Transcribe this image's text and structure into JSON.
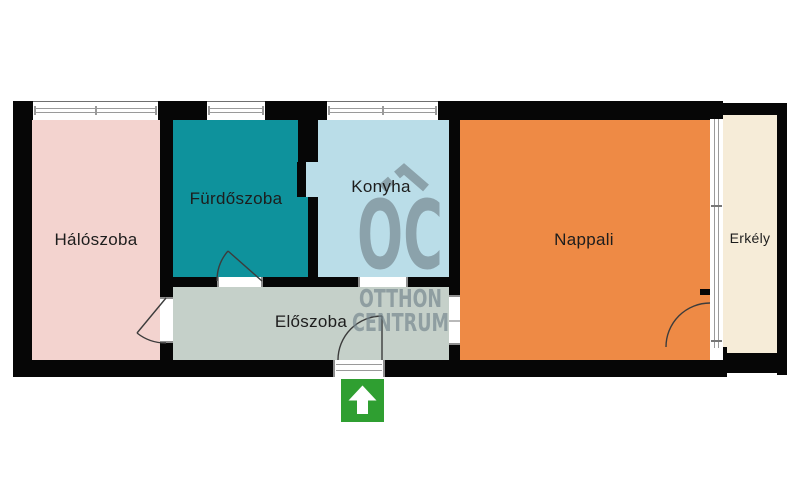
{
  "floorplan": {
    "rooms": {
      "bedroom": {
        "label": "Hálószoba",
        "color": "#f3d3cf"
      },
      "bathroom": {
        "label": "Fürdőszoba",
        "color": "#0e929c"
      },
      "kitchen": {
        "label": "Konyha",
        "color": "#badde8"
      },
      "hallway": {
        "label": "Előszoba",
        "color": "#c5d0c9"
      },
      "living_room": {
        "label": "Nappali",
        "color": "#ee8a45"
      },
      "balcony": {
        "label": "Erkély",
        "color": "#f6ecd8"
      }
    },
    "colors": {
      "wall": "#060606",
      "window_frame": "#9a9a9a",
      "door_swing": "#3c3c3c",
      "entrance_arrow": "#2f9f31",
      "watermark": "#74858d"
    },
    "watermark": {
      "logo": "OC",
      "line1": "OTTHON",
      "line2": "CENTRUM"
    },
    "icons": {
      "entrance_arrow": "up-arrow",
      "logo_roof": "house-roof"
    }
  }
}
